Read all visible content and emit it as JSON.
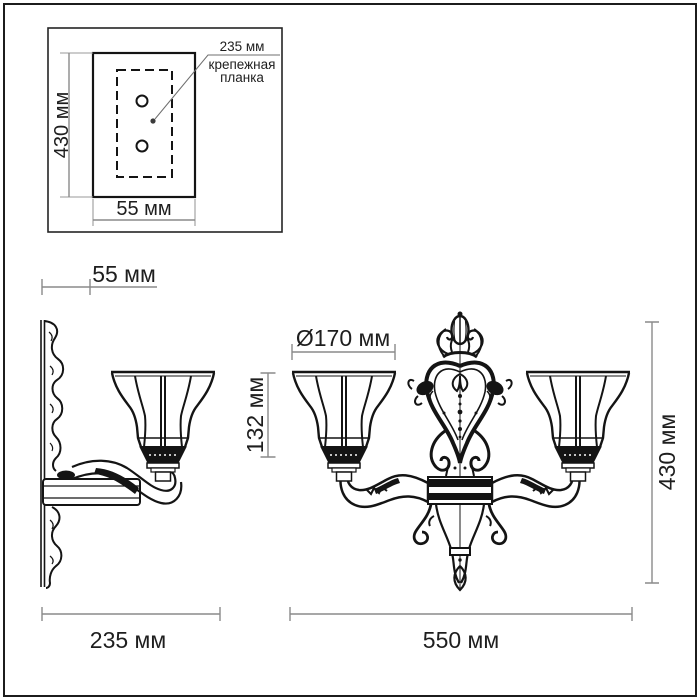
{
  "inset": {
    "height": "430 мм",
    "width": "55 мм",
    "callout_value": "235 мм",
    "callout_label_line1": "крепежная",
    "callout_label_line2": "планка"
  },
  "main": {
    "wall_depth": "55 мм",
    "shade_diameter": "Ø170 мм",
    "shade_height": "132 мм",
    "total_height": "430 мм",
    "side_width": "235 мм",
    "front_width": "550 мм"
  },
  "colors": {
    "ink": "#141414",
    "dimension_line": "#8a8a8a",
    "label_text": "#1e1e1e",
    "background": "#ffffff",
    "frame_border": "#1c1c1c"
  }
}
